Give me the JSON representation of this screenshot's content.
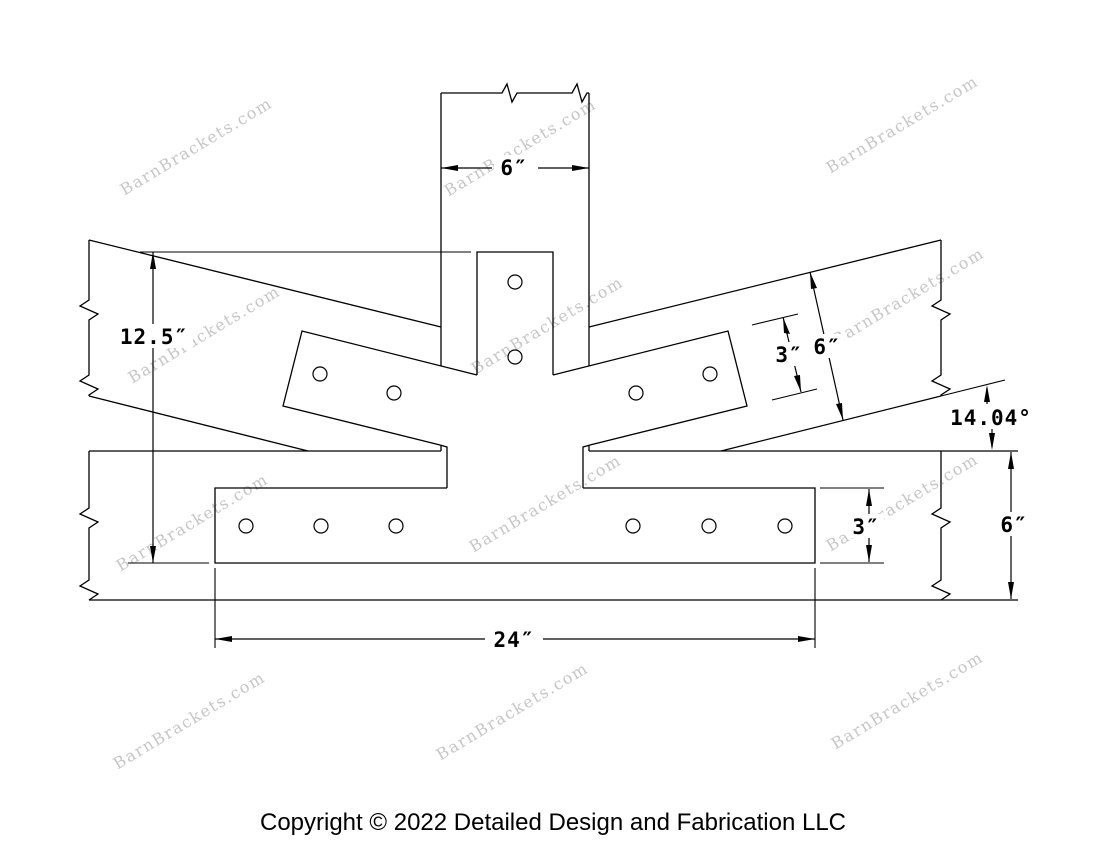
{
  "watermarks": {
    "text": "BarnBrackets.com",
    "color": "#c6c6c6",
    "angle_deg": -31,
    "positions": [
      [
        199,
        151
      ],
      [
        523,
        152
      ],
      [
        905,
        129
      ],
      [
        207,
        339
      ],
      [
        550,
        330
      ],
      [
        911,
        301
      ],
      [
        195,
        527
      ],
      [
        548,
        508
      ],
      [
        905,
        507
      ],
      [
        192,
        725
      ],
      [
        515,
        716
      ],
      [
        910,
        705
      ]
    ]
  },
  "dimensions": {
    "post_width": "6″",
    "overall_height": "12.5″",
    "arm_plate_width": "3″",
    "rafter_depth": "6″",
    "angle": "14.04°",
    "base_plate_height": "3″",
    "chord_depth": "6″",
    "base_plate_length": "24″"
  },
  "holes": {
    "radius": 7,
    "centers": [
      [
        515,
        282
      ],
      [
        515,
        357
      ],
      [
        320,
        374
      ],
      [
        394,
        393
      ],
      [
        636,
        393
      ],
      [
        710,
        374
      ],
      [
        246,
        526
      ],
      [
        321,
        526
      ],
      [
        396,
        526
      ],
      [
        633,
        526
      ],
      [
        709,
        526
      ],
      [
        785,
        526
      ]
    ]
  },
  "footer": {
    "copyright": "Copyright © 2022 Detailed Design and Fabrication LLC"
  }
}
